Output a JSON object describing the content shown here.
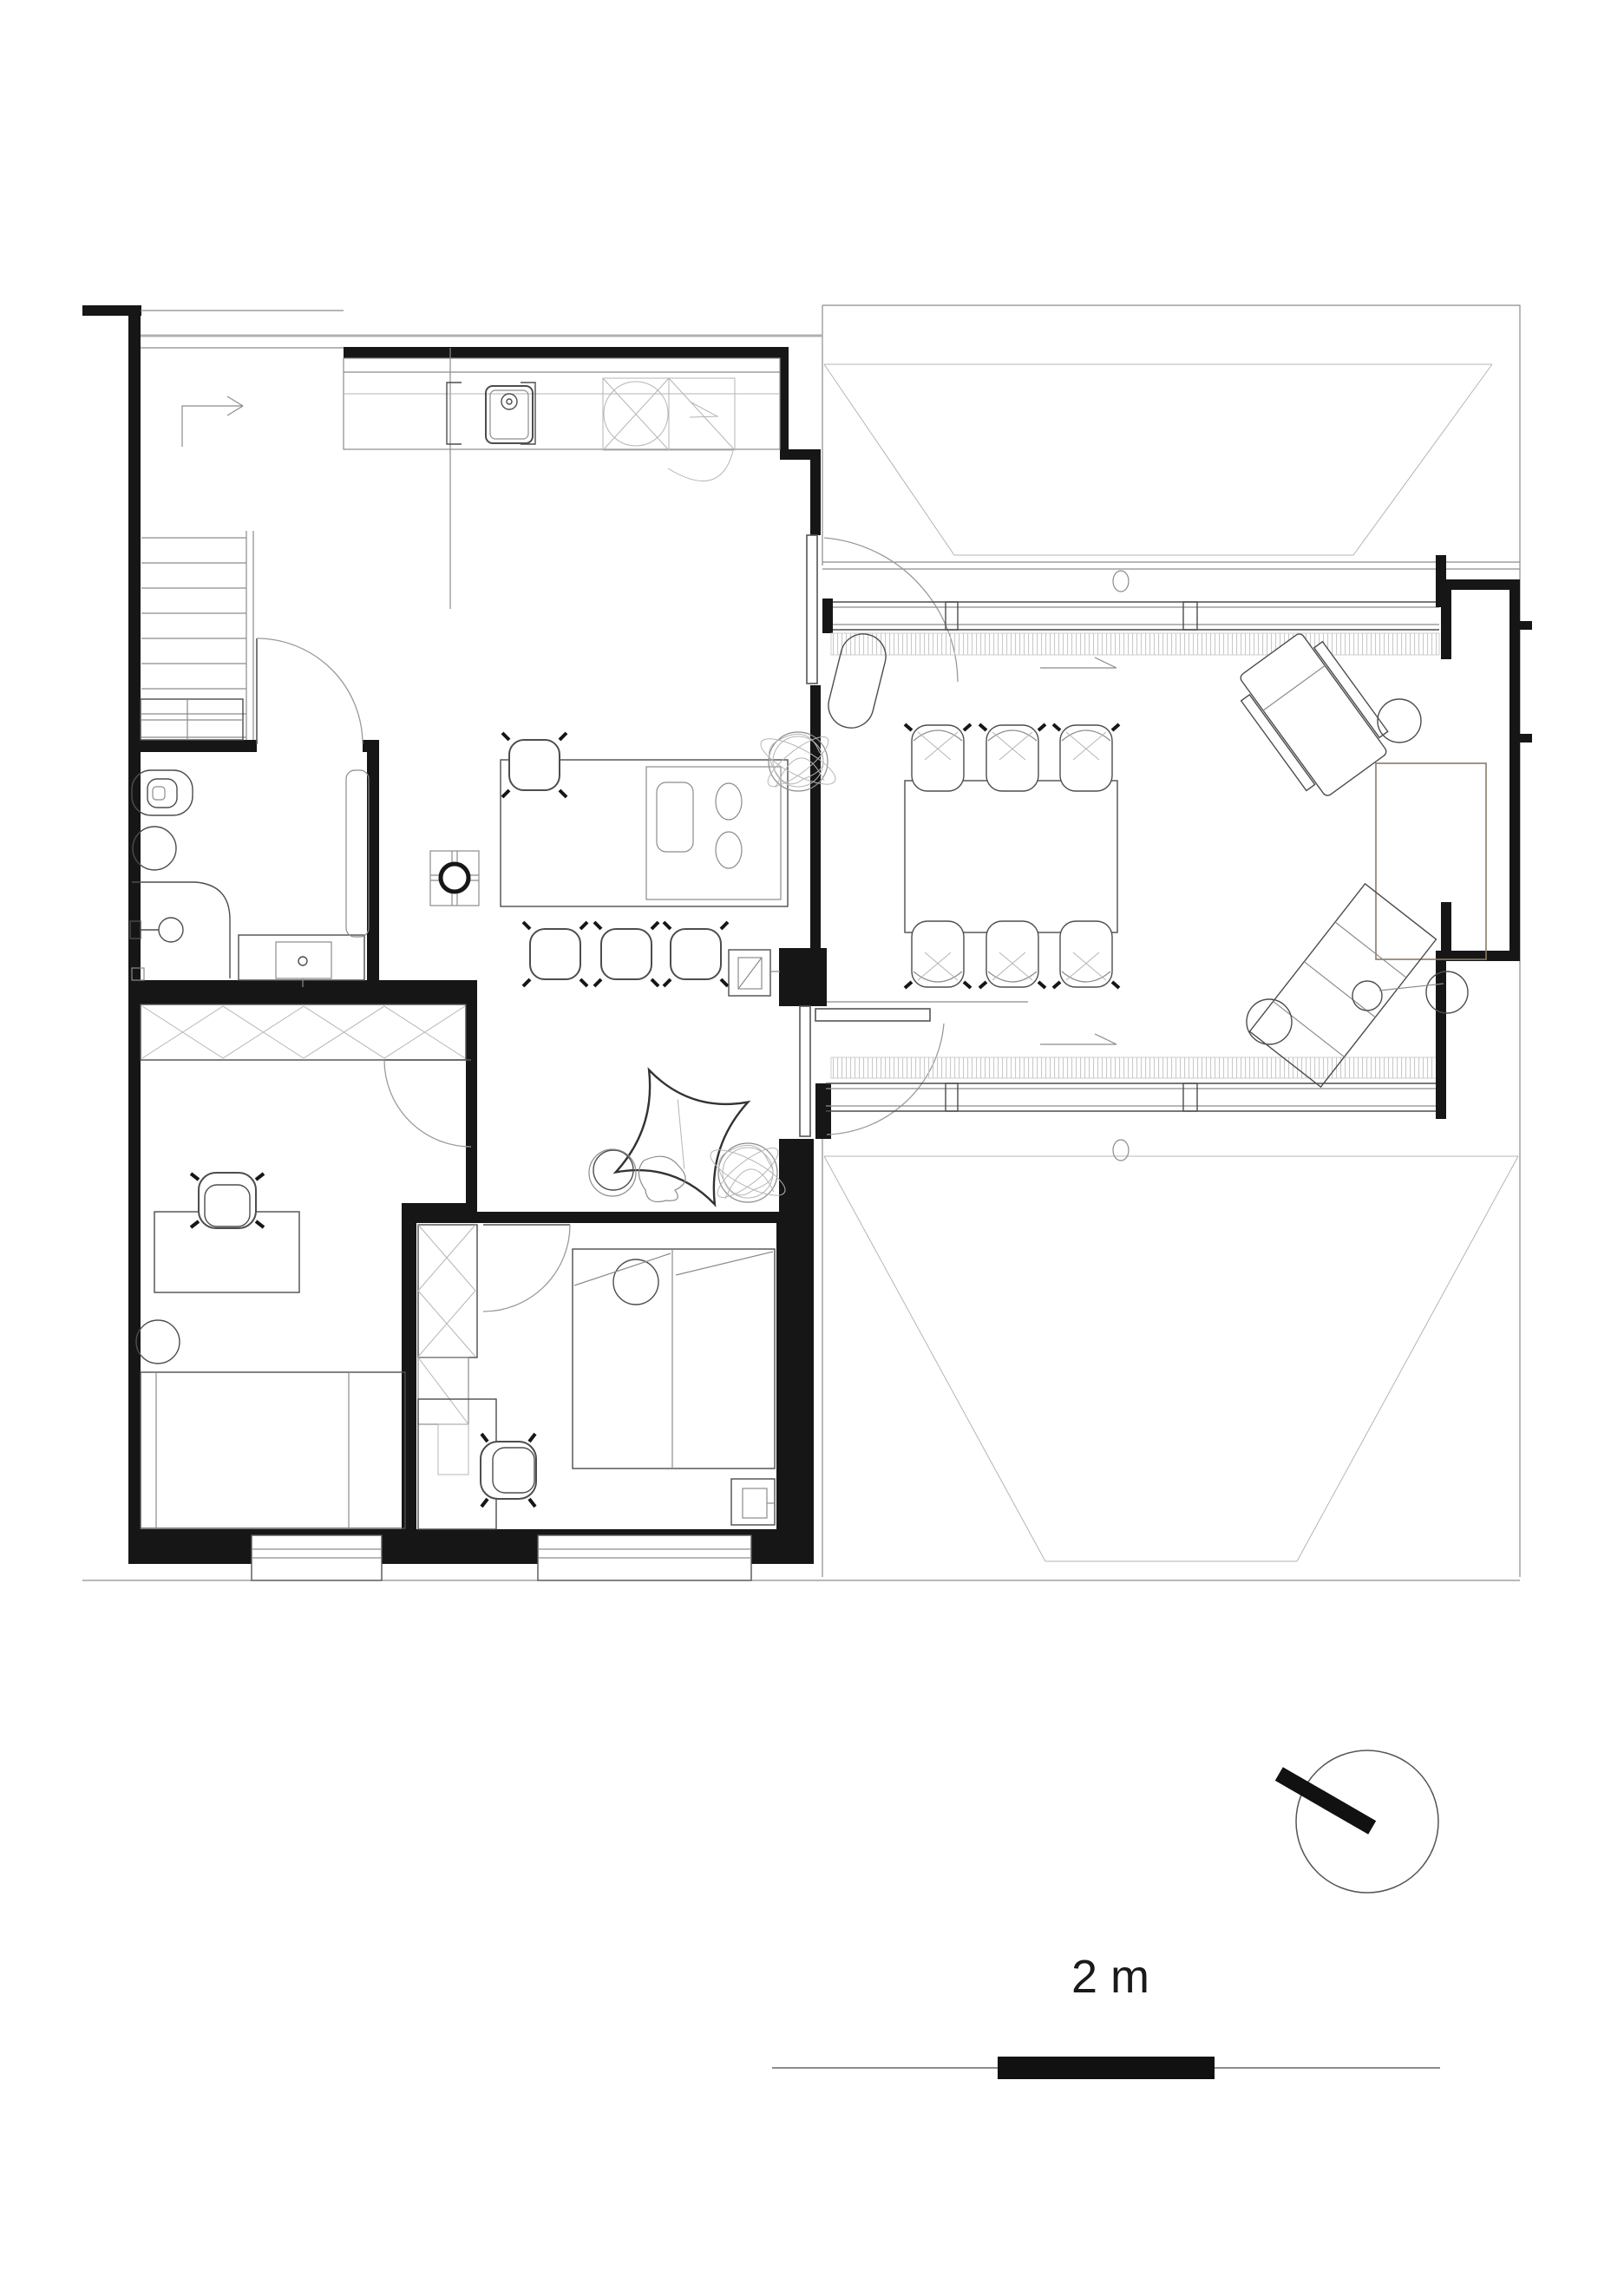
{
  "drawing": {
    "kind": "architectural floor plan, black line work on white",
    "scale": {
      "label": "2 m"
    },
    "colors": {
      "ink": "#161616",
      "furniture_line": "#4d4d4d",
      "thin_line": "#8c8c8c",
      "hatch_line": "#c4c4c4",
      "wood_accent": "#8a7a66",
      "background": "#ffffff"
    },
    "icons": [
      {
        "name": "north-indicator",
        "shape": "circle with thick bar pointing upper-left"
      },
      {
        "name": "scale-bar",
        "shape": "thin rule with solid centre segment"
      },
      {
        "name": "stair-direction-arrow",
        "shape": "polyline with open arrowhead"
      },
      {
        "name": "floor-drain",
        "shape": "small ellipse"
      },
      {
        "name": "stove-flue",
        "shape": "square with cross and bold circle"
      }
    ]
  }
}
